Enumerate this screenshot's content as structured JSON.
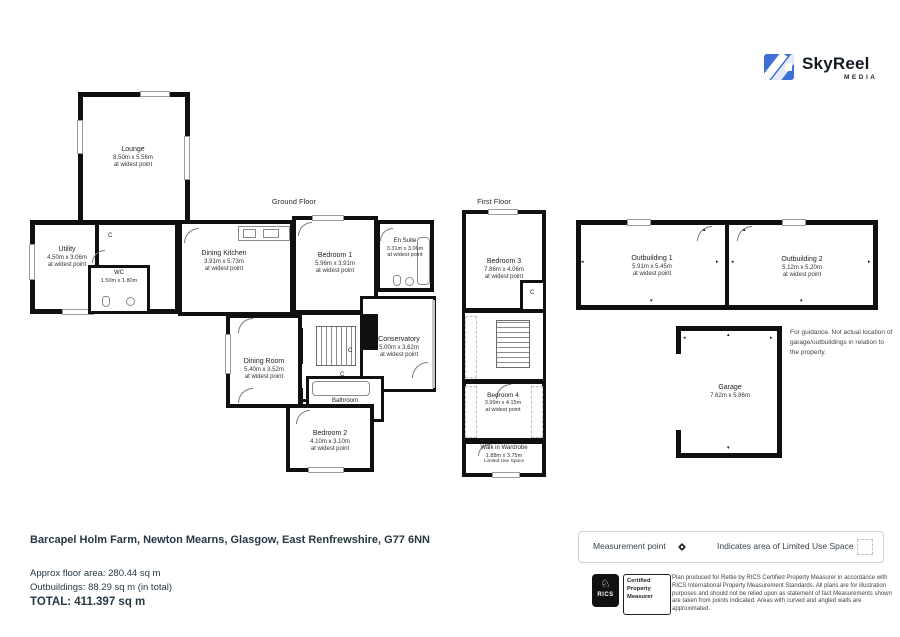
{
  "logo": {
    "brand": "SkyReel",
    "sub": "MEDIA",
    "accent_color": "#3e6fd5"
  },
  "floors": {
    "ground": "Ground Floor",
    "first": "First Floor"
  },
  "cupboard_label": "C",
  "rooms": {
    "lounge": {
      "name": "Lounge",
      "dims": "8.50m x 5.56m",
      "note": "at widest point"
    },
    "utility": {
      "name": "Utility",
      "dims": "4.50m x 3.06m",
      "note": "at widest point"
    },
    "wc": {
      "name": "WC",
      "dims": "1.50m x 1.80m",
      "note": ""
    },
    "dining_kitchen": {
      "name": "Dining Kitchen",
      "dims": "3.91m x 5.73m",
      "note": "at widest point"
    },
    "bedroom1": {
      "name": "Bedroom 1",
      "dims": "5.96m x 3.91m",
      "note": "at widest point"
    },
    "en_suite": {
      "name": "En Suite",
      "dims": "3.31m x 3.06m",
      "note": "at widest point"
    },
    "dining_room": {
      "name": "Dining Room",
      "dims": "5.40m x 3.52m",
      "note": "at widest point"
    },
    "conservatory": {
      "name": "Conservatory",
      "dims": "5.00m x 3.62m",
      "note": "at widest point"
    },
    "bathroom": {
      "name": "Bathroom",
      "dims": "3.72m x 1.39m",
      "note": "at widest point"
    },
    "bedroom2": {
      "name": "Bedroom 2",
      "dims": "4.10m x 3.10m",
      "note": "at widest point"
    },
    "bedroom3": {
      "name": "Bedroom 3",
      "dims": "7.86m x 4.06m",
      "note": "at widest point"
    },
    "bedroom4": {
      "name": "Bedroom 4",
      "dims": "3.99m x 4.15m",
      "note": "at widest point"
    },
    "wardrobe": {
      "name": "Walk in Wardrobe",
      "dims": "1.88m x 3.75m",
      "note": "Limited Use Space"
    },
    "outbuilding1": {
      "name": "Outbuilding 1",
      "dims": "5.91m x 5.45m",
      "note": "at widest point"
    },
    "outbuilding2": {
      "name": "Outbuilding 2",
      "dims": "5.12m x 5.20m",
      "note": "at widest point"
    },
    "garage": {
      "name": "Garage",
      "dims": "7.62m x 5.86m",
      "note": ""
    }
  },
  "guidance_note": "For guidance. Not actual location of garage/outbuildings in relation to the property.",
  "address": "Barcapel Holm Farm, Newton Mearns, Glasgow, East Renfrewshire, G77 6NN",
  "legend": {
    "measurement_point": "Measurement point",
    "limited_use": "Indicates area of  Limited Use Space"
  },
  "areas": {
    "floor": "Approx floor area: 280.44 sq m",
    "outbuildings": "Outbuildings: 88.29 sq m (in total)",
    "total": "TOTAL: 411.397 sq m"
  },
  "certification": {
    "rics": "RICS",
    "badge": "Certified Property Measurer",
    "disclaimer": "Plan produced for Rettie by RICS Certified Property Measurer in accordance with RICS International Property  Measurement Standards.  All plans are for illustration purposes and should not be relied upon as statement of fact Measurements shown are taken from points indicated. Areas with curved and angled walls are approximated."
  }
}
